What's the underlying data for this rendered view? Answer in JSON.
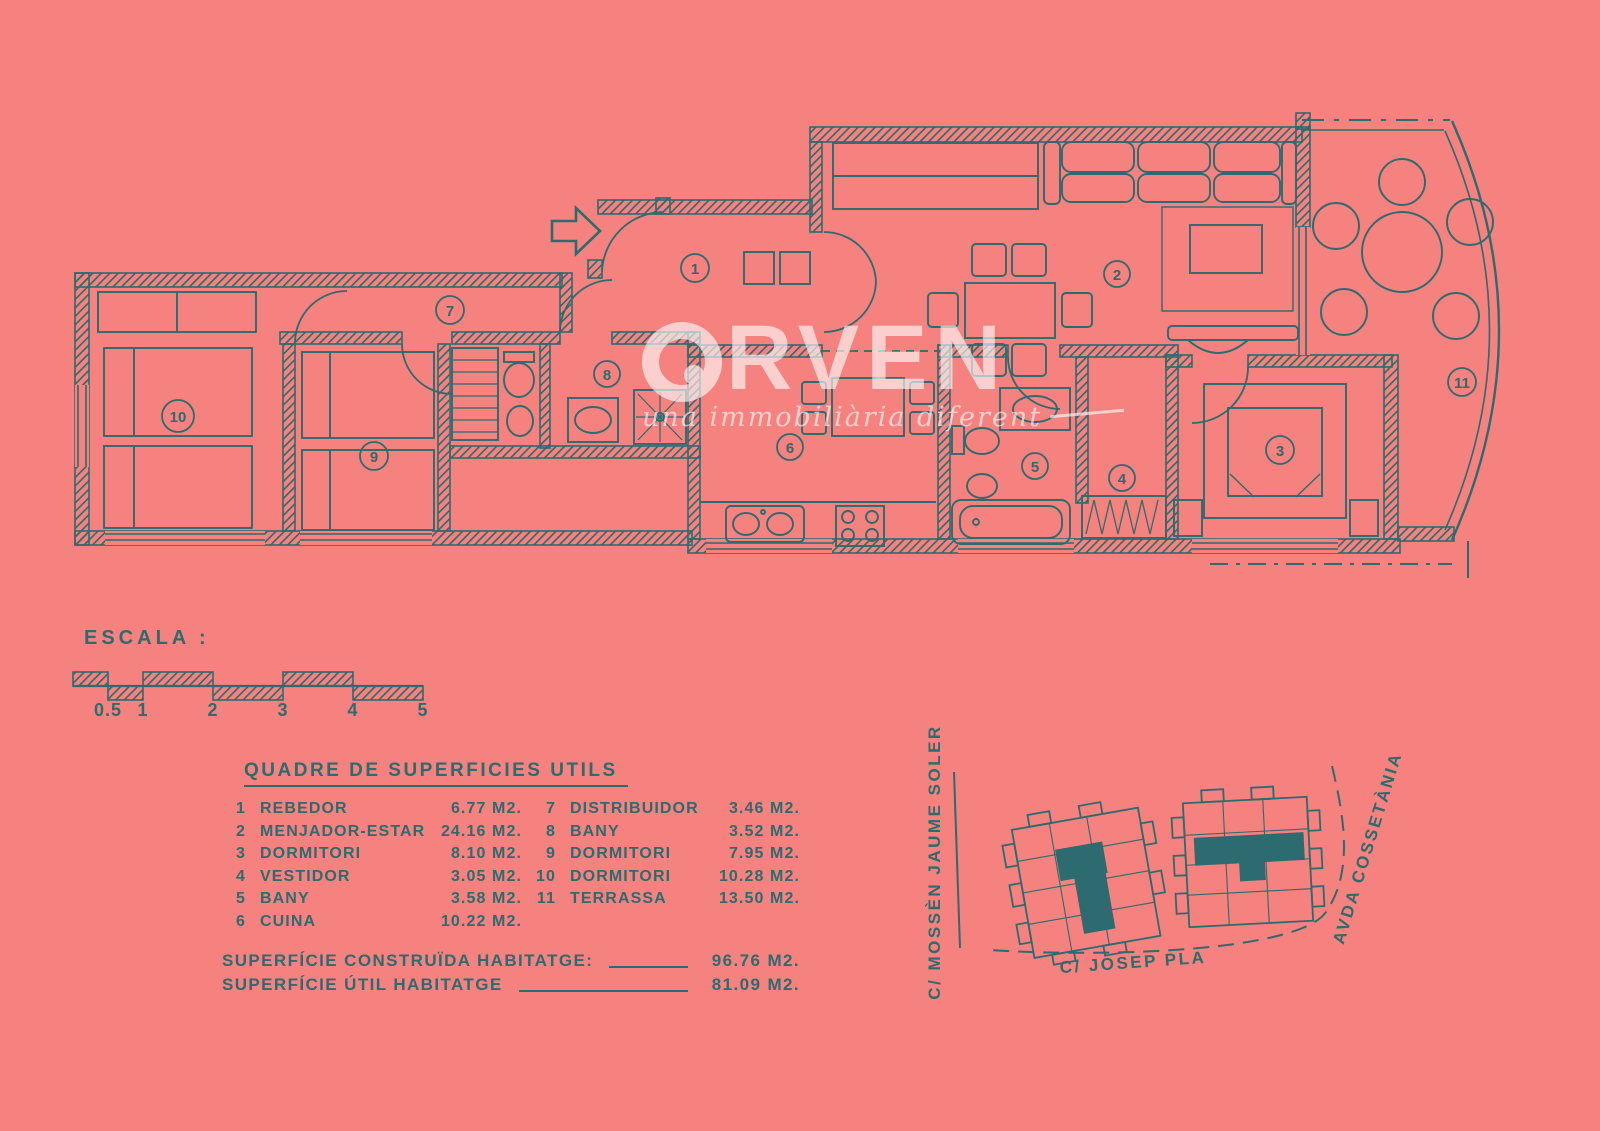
{
  "palette": {
    "background": "#f5827e",
    "ink": "#2c6b6f",
    "watermark": "#ffffff"
  },
  "watermark": {
    "brand": "ORVEN",
    "brand_display_rest": "RVEN",
    "tagline": "una immobiliària diferent"
  },
  "plan": {
    "room_numbers": [
      "1",
      "2",
      "3",
      "4",
      "5",
      "6",
      "7",
      "8",
      "9",
      "10",
      "11"
    ]
  },
  "scale_bar": {
    "label": "ESCALA :",
    "ticks": [
      "0.5",
      "1",
      "2",
      "3",
      "4",
      "5"
    ]
  },
  "areas_table": {
    "title": "QUADRE DE SUPERFICIES UTILS",
    "left_rows": [
      {
        "num": "1",
        "name": "REBEDOR",
        "area": "6.77 M2."
      },
      {
        "num": "2",
        "name": "MENJADOR-ESTAR",
        "area": "24.16 M2."
      },
      {
        "num": "3",
        "name": "DORMITORI",
        "area": "8.10 M2."
      },
      {
        "num": "4",
        "name": "VESTIDOR",
        "area": "3.05 M2."
      },
      {
        "num": "5",
        "name": "BANY",
        "area": "3.58 M2."
      },
      {
        "num": "6",
        "name": "CUINA",
        "area": "10.22 M2."
      }
    ],
    "right_rows": [
      {
        "num": "7",
        "name": "DISTRIBUIDOR",
        "area": "3.46 M2."
      },
      {
        "num": "8",
        "name": "BANY",
        "area": "3.52 M2."
      },
      {
        "num": "9",
        "name": "DORMITORI",
        "area": "7.95 M2."
      },
      {
        "num": "10",
        "name": "DORMITORI",
        "area": "10.28 M2."
      },
      {
        "num": "11",
        "name": "TERRASSA",
        "area": "13.50 M2."
      }
    ],
    "totals": [
      {
        "label": "SUPERFÍCIE CONSTRUÏDA HABITATGE:",
        "value": "96.76 M2."
      },
      {
        "label": "SUPERFÍCIE ÚTIL HABITATGE",
        "value": "81.09 M2."
      }
    ]
  },
  "site_plan": {
    "street_left": "C/ MOSSÈN JAUME SOLER",
    "street_right": "AVDA COSSETÀNIA",
    "street_bottom": "C/ JOSEP PLA"
  }
}
